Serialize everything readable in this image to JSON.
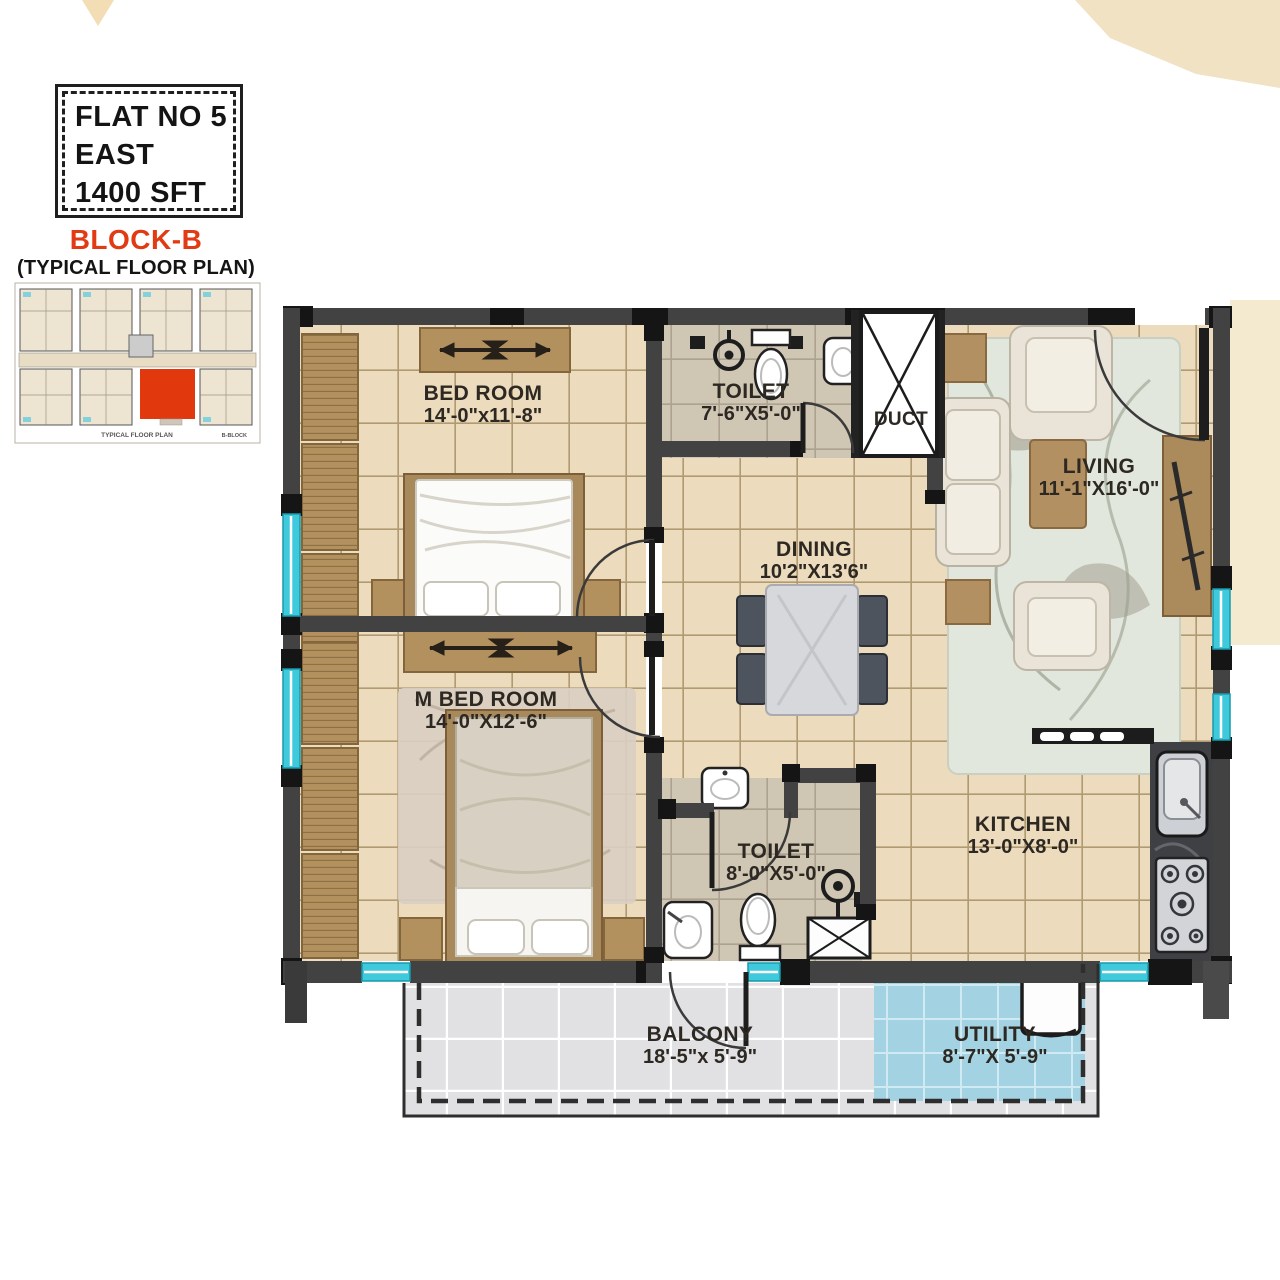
{
  "info_box": {
    "line1": "FLAT NO 5",
    "line2": "EAST",
    "line3": "1400 SFT"
  },
  "block_header": {
    "title": "BLOCK-B",
    "subtitle": "(TYPICAL FLOOR PLAN)"
  },
  "thumbnail": {
    "caption": "TYPICAL FLOOR PLAN",
    "block_label": "B-BLOCK"
  },
  "rooms": {
    "bedroom": {
      "name": "BED ROOM",
      "dims": "14'-0\"x11'-8\""
    },
    "toilet_top": {
      "name": "TOILET",
      "dims": "7'-6\"X5'-0\""
    },
    "duct": {
      "name": "DUCT"
    },
    "living": {
      "name": "LIVING",
      "dims": "11'-1\"X16'-0\""
    },
    "dining": {
      "name": "DINING",
      "dims": "10'2\"X13'6\""
    },
    "master_bedroom": {
      "name": "M BED ROOM",
      "dims": "14'-0\"X12'-6\""
    },
    "toilet_bottom": {
      "name": "TOILET",
      "dims": "8'-0\"X5'-0\""
    },
    "kitchen": {
      "name": "KITCHEN",
      "dims": "13'-0\"X8'-0\""
    },
    "balcony": {
      "name": "BALCONY",
      "dims": "18'-5\"x 5'-9\""
    },
    "utility": {
      "name": "UTILITY",
      "dims": "8'-7\"X 5'-9\""
    }
  },
  "colors": {
    "accent": "#e23a12",
    "window": "#3ec9dc",
    "wall": "#424242",
    "floor": "#ecdcbd",
    "utility_floor": "#a3d2e2",
    "balcony_floor": "#e1e1e4"
  }
}
